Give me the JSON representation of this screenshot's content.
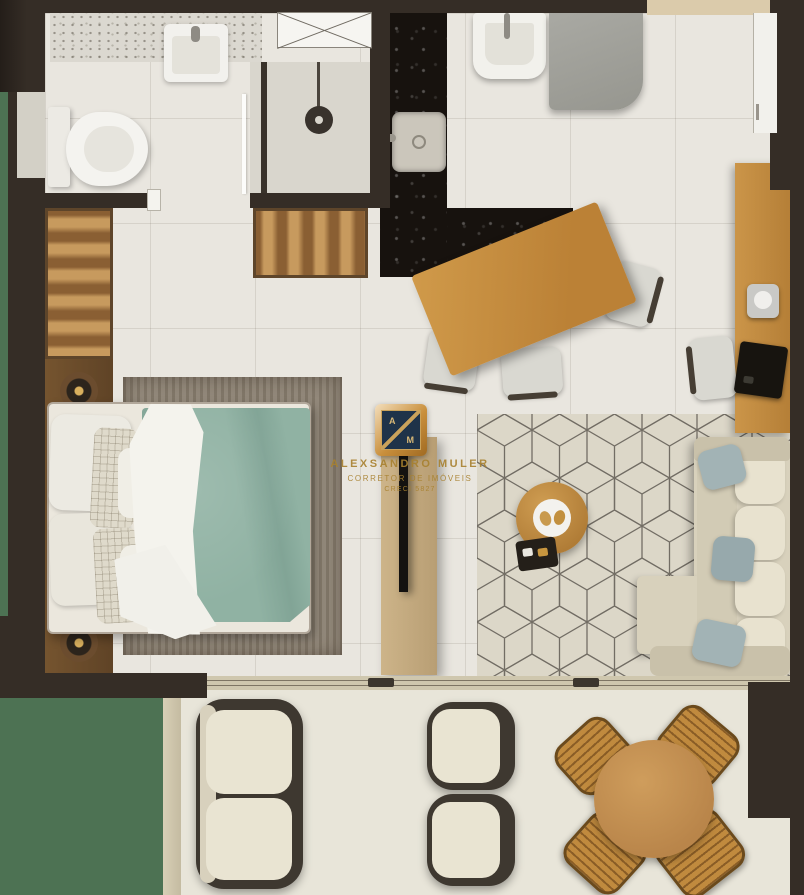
{
  "watermark": {
    "logo_letter_top": "A",
    "logo_letter_bottom": "M",
    "name": "ALEXSANDRO MULER",
    "title": "CORRETOR DE IMÓVEIS",
    "license": "CRECI 5827"
  },
  "palette": {
    "wall": "#352d26",
    "floor": "#e9e6df",
    "balcony_floor": "#e8e5d9",
    "grass": "#4d7253",
    "wood_warm": "#c89245",
    "wood_panel": "#c6ac82",
    "marble_black": "#17120e",
    "duvet_teal": "#90b2a3",
    "sofa_cream": "#ddd6c2",
    "pillow_blue": "#a2b3b5",
    "rug_living": "#dcd7c8",
    "rug_bedroom": "#8c8273",
    "logo_navy": "#1f3349",
    "logo_gold": "#c9a25b",
    "watermark_gold": "#a8812f"
  }
}
